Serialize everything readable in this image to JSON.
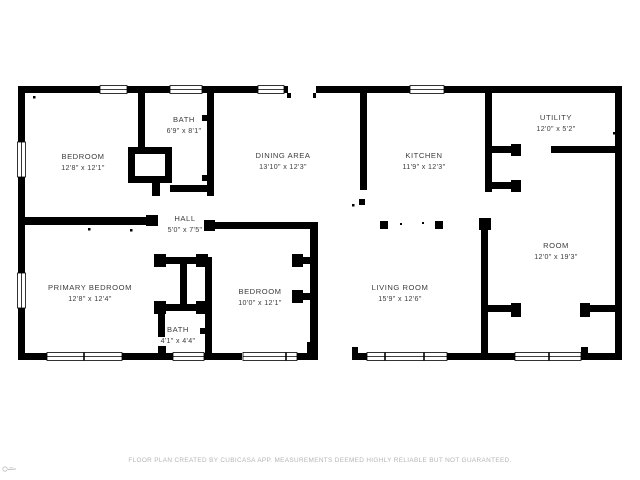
{
  "floor_plan": {
    "rooms": [
      {
        "name": "BATH",
        "dims": "6'9\" x 8'1\""
      },
      {
        "name": "BEDROOM",
        "dims": "12'8\" x 12'1\""
      },
      {
        "name": "DINING AREA",
        "dims": "13'10\" x 12'3\""
      },
      {
        "name": "KITCHEN",
        "dims": "11'9\" x 12'3\""
      },
      {
        "name": "UTILITY",
        "dims": "12'0\" x 5'2\""
      },
      {
        "name": "HALL",
        "dims": "5'0\" x 7'5\""
      },
      {
        "name": "PRIMARY BEDROOM",
        "dims": "12'8\" x 12'4\""
      },
      {
        "name": "BEDROOM",
        "dims": "10'0\" x 12'1\""
      },
      {
        "name": "BATH",
        "dims": "4'1\" x 4'4\""
      },
      {
        "name": "LIVING ROOM",
        "dims": "15'9\" x 12'6\""
      },
      {
        "name": "ROOM",
        "dims": "12'0\" x 19'3\""
      }
    ],
    "footer": "FLOOR PLAN CREATED BY CUBICASA APP. MEASUREMENTS DEEMED HIGHLY RELIABLE BUT NOT GUARANTEED.",
    "colors": {
      "wall": "#000000",
      "background": "#ffffff",
      "label_text": "#3c3c3c",
      "footer_text": "#b5b5b5"
    }
  }
}
